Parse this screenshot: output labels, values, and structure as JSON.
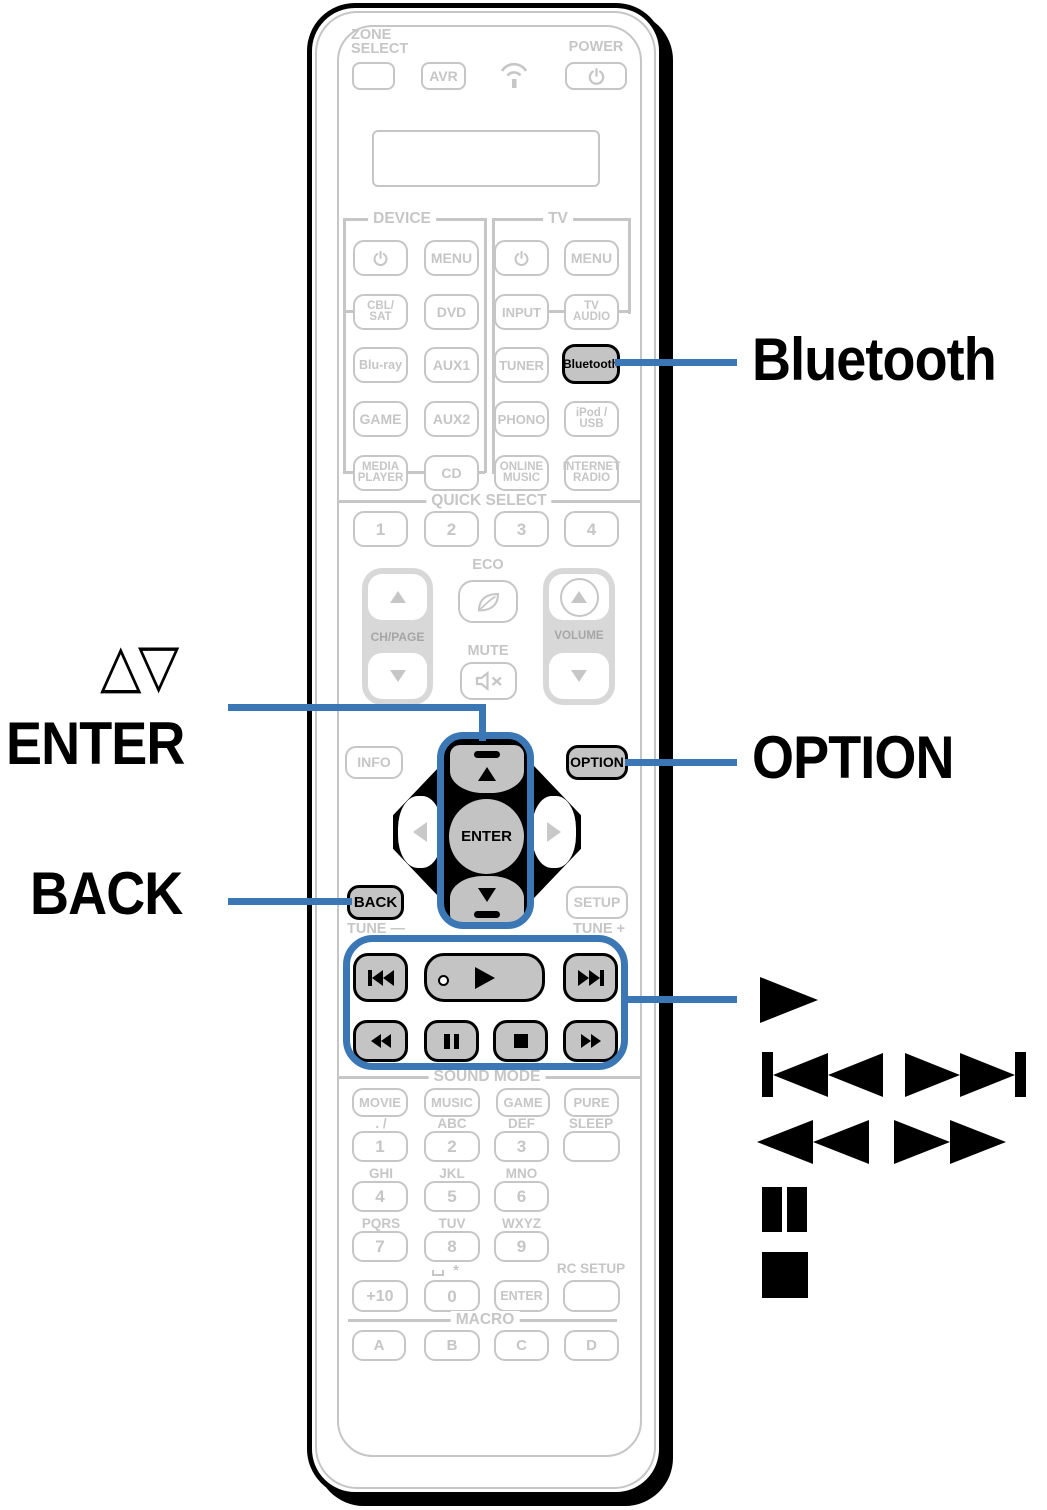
{
  "colors": {
    "accent_blue": "#3b76b5",
    "line_gray": "#c6c6c6",
    "highlight_fill": "#c4c4c4",
    "band_gray": "#d8d8d8",
    "ink": "#000000"
  },
  "callouts": {
    "bluetooth": "Bluetooth",
    "cursor_updown": "△▽",
    "enter": "ENTER",
    "back": "BACK",
    "option": "OPTION"
  },
  "icons": {
    "top": [
      "power-icon",
      "transmit-icon"
    ],
    "middle": [
      "eco-leaf-icon",
      "mute-speaker-icon"
    ],
    "playback": [
      "skip-back-icon",
      "play-icon",
      "skip-forward-icon",
      "rewind-icon",
      "pause-icon",
      "stop-icon",
      "fast-forward-icon"
    ]
  },
  "top": {
    "zone_select": "ZONE\nSELECT",
    "avr": "AVR",
    "power": "POWER"
  },
  "sections": {
    "device": "DEVICE",
    "tv": "TV",
    "quick_select": "QUICK SELECT",
    "sound_mode": "SOUND MODE",
    "macro": "MACRO"
  },
  "device": {
    "menu": "MENU",
    "cbl_sat": "CBL/\nSAT",
    "dvd": "DVD",
    "blu_ray": "Blu-ray",
    "aux1": "AUX1",
    "game": "GAME",
    "aux2": "AUX2",
    "media_player": "MEDIA\nPLAYER",
    "cd": "CD"
  },
  "tv": {
    "menu": "MENU",
    "input": "INPUT",
    "tv_audio": "TV\nAUDIO",
    "tuner": "TUNER",
    "bluetooth": "Bluetooth",
    "phono": "PHONO",
    "ipod_usb": "iPod /\nUSB",
    "online_music": "ONLINE\nMUSIC",
    "internet_radio": "INTERNET\nRADIO"
  },
  "quick_select": {
    "b1": "1",
    "b2": "2",
    "b3": "3",
    "b4": "4"
  },
  "middle": {
    "ch_page": "CH/PAGE",
    "eco": "ECO",
    "mute": "MUTE",
    "volume": "VOLUME"
  },
  "nav": {
    "info": "INFO",
    "option": "OPTION",
    "enter": "ENTER",
    "back": "BACK",
    "setup": "SETUP"
  },
  "tune": {
    "minus": "TUNE —",
    "plus": "TUNE +"
  },
  "sound_mode": {
    "movie": "MOVIE",
    "music": "MUSIC",
    "game": "GAME",
    "pure": "PURE"
  },
  "keypad": {
    "r1_hints": {
      "h1": ". /",
      "h2": "ABC",
      "h3": "DEF",
      "sleep": "SLEEP"
    },
    "r1": {
      "b1": "1",
      "b2": "2",
      "b3": "3"
    },
    "r2_hints": {
      "h1": "GHI",
      "h2": "JKL",
      "h3": "MNO"
    },
    "r2": {
      "b1": "4",
      "b2": "5",
      "b3": "6"
    },
    "r3_hints": {
      "h1": "PQRS",
      "h2": "TUV",
      "h3": "WXYZ"
    },
    "r3": {
      "b1": "7",
      "b2": "8",
      "b3": "9"
    },
    "r4_hints": {
      "star": "*",
      "rc_setup": "RC SETUP"
    },
    "r4": {
      "plus10": "+10",
      "b0": "0",
      "enter": "ENTER"
    }
  },
  "macro": {
    "a": "A",
    "b": "B",
    "c": "C",
    "d": "D"
  }
}
